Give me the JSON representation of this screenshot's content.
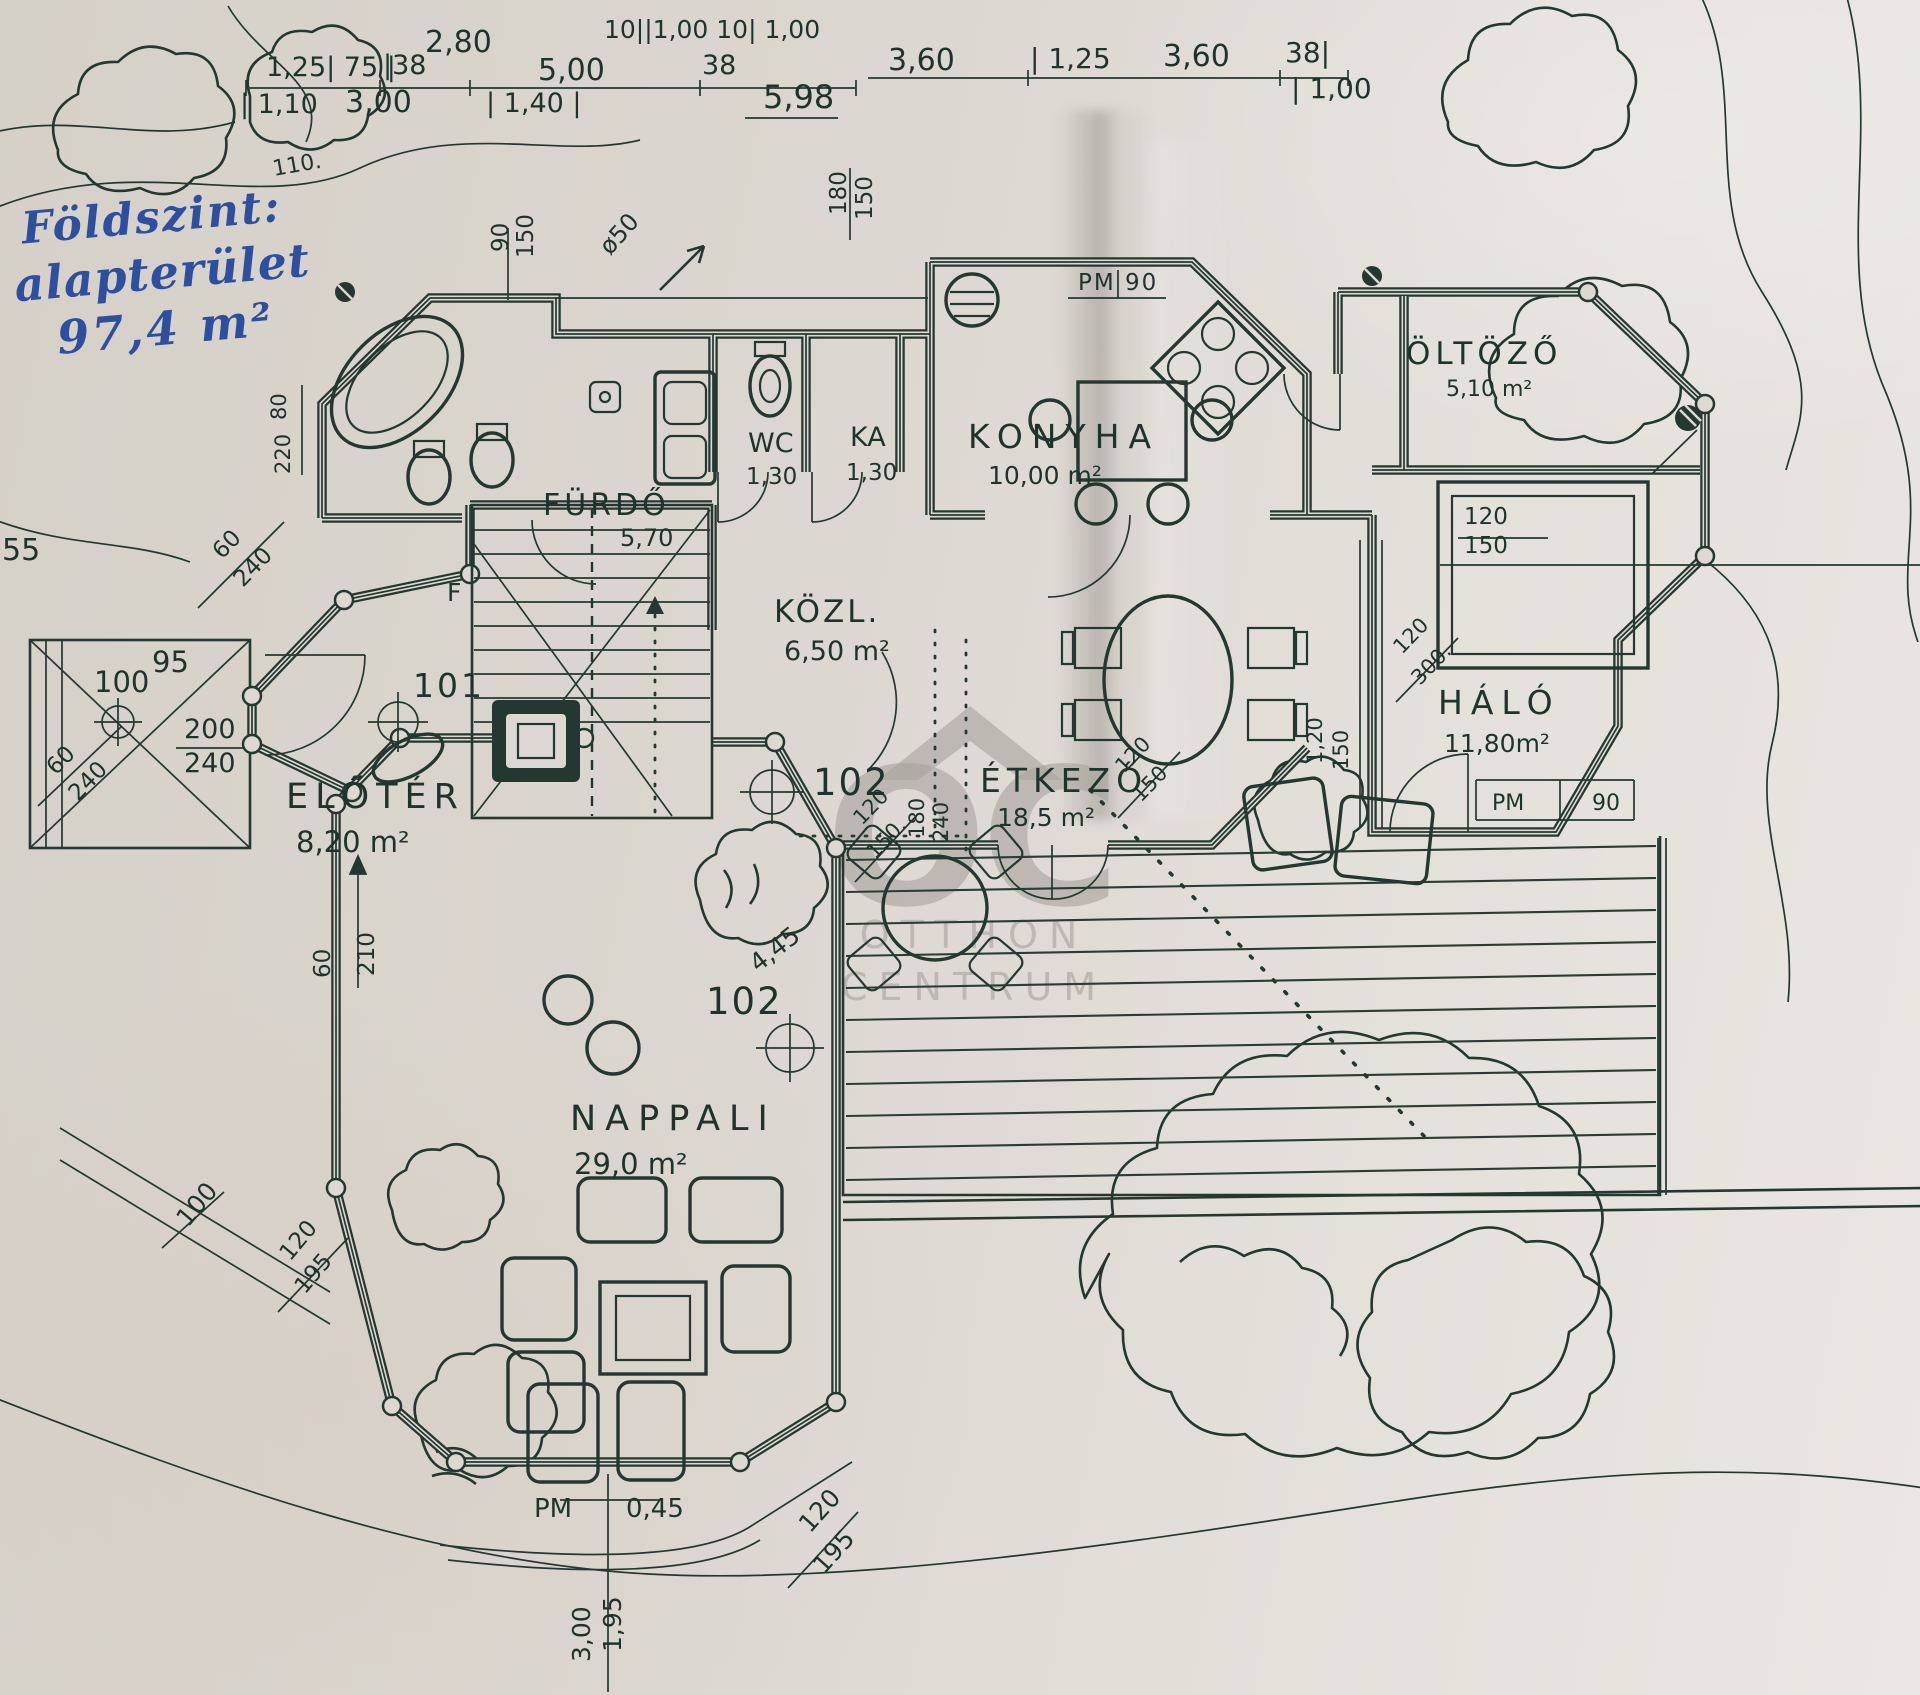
{
  "annotation": {
    "line1": "Földszint:",
    "line2": "alapterület",
    "line3": "97,4 m²",
    "color": "#2d4f9e"
  },
  "watermark": {
    "initials": "OC",
    "line1": "OTTHON",
    "line2": "CENTRUM",
    "color": "#a9a59e"
  },
  "ink_color": "#243831",
  "paper_color": "#ddd8d1",
  "plan_texts": [
    {
      "id": "dim-top-280",
      "t": "2,80",
      "x": 425,
      "y": 52,
      "s": 30
    },
    {
      "id": "dim-top-seq",
      "t": "10||1,00 10| 1,00",
      "x": 604,
      "y": 38,
      "s": 25
    },
    {
      "id": "dim-top-125-75",
      "t": "1,25| 75 |",
      "x": 266,
      "y": 76,
      "s": 27
    },
    {
      "id": "dim-top-38a",
      "t": "|38",
      "x": 383,
      "y": 74,
      "s": 27
    },
    {
      "id": "dim-top-500",
      "t": "5,00",
      "x": 538,
      "y": 80,
      "s": 30
    },
    {
      "id": "dim-top-38b",
      "t": "38",
      "x": 702,
      "y": 74,
      "s": 27
    },
    {
      "id": "dim-top-110",
      "t": "| 1,10",
      "x": 240,
      "y": 113,
      "s": 27
    },
    {
      "id": "dim-top-300",
      "t": "3,00",
      "x": 345,
      "y": 112,
      "s": 30
    },
    {
      "id": "dim-top-140",
      "t": "| 1,40 |",
      "x": 486,
      "y": 112,
      "s": 27
    },
    {
      "id": "dim-top-598",
      "t": "5,98",
      "x": 763,
      "y": 108,
      "s": 32
    },
    {
      "id": "dim-top-360a",
      "t": "3,60",
      "x": 888,
      "y": 70,
      "s": 30
    },
    {
      "id": "dim-top-125b",
      "t": "| 1,25",
      "x": 1030,
      "y": 68,
      "s": 28
    },
    {
      "id": "dim-top-360b",
      "t": "3,60",
      "x": 1163,
      "y": 66,
      "s": 30
    },
    {
      "id": "dim-top-38c",
      "t": "38|",
      "x": 1285,
      "y": 62,
      "s": 28
    },
    {
      "id": "dim-top-100",
      "t": "| 1,00",
      "x": 1291,
      "y": 98,
      "s": 28
    },
    {
      "id": "contour-110",
      "t": "110.",
      "x": 274,
      "y": 176,
      "s": 22,
      "rot": -10
    },
    {
      "id": "dim-v-90",
      "t": "90",
      "x": 508,
      "y": 252,
      "s": 23,
      "rot": -90
    },
    {
      "id": "dim-v-150",
      "t": "150",
      "x": 533,
      "y": 258,
      "s": 23,
      "rot": -90
    },
    {
      "id": "dim-diam-50",
      "t": "ø50",
      "x": 610,
      "y": 256,
      "s": 24,
      "rot": -48
    },
    {
      "id": "dim-v-180",
      "t": "180",
      "x": 846,
      "y": 215,
      "s": 23,
      "rot": -90
    },
    {
      "id": "dim-v-150b",
      "t": "150",
      "x": 872,
      "y": 220,
      "s": 23,
      "rot": -90
    },
    {
      "id": "pm-konyha",
      "t": "PM 90",
      "x": 1078,
      "y": 290,
      "s": 23,
      "ls": 2
    },
    {
      "id": "dim-left-55",
      "t": "55",
      "x": 2,
      "y": 560,
      "s": 30
    },
    {
      "id": "dim-left-80",
      "t": "80",
      "x": 286,
      "y": 420,
      "s": 21,
      "rot": -90
    },
    {
      "id": "dim-left-220",
      "t": "220",
      "x": 290,
      "y": 474,
      "s": 21,
      "rot": -90
    },
    {
      "id": "dim-diag-60a",
      "t": "60",
      "x": 222,
      "y": 560,
      "s": 23,
      "rot": -46
    },
    {
      "id": "dim-diag-240a",
      "t": "240",
      "x": 243,
      "y": 588,
      "s": 23,
      "rot": -46
    },
    {
      "id": "dim-annex-95",
      "t": "95",
      "x": 152,
      "y": 672,
      "s": 29
    },
    {
      "id": "dim-annex-100",
      "t": "100",
      "x": 94,
      "y": 692,
      "s": 29
    },
    {
      "id": "dim-annex-200",
      "t": "200",
      "x": 184,
      "y": 738,
      "s": 27
    },
    {
      "id": "dim-annex-240",
      "t": "240",
      "x": 184,
      "y": 772,
      "s": 27
    },
    {
      "id": "marker-101",
      "t": "101",
      "x": 413,
      "y": 697,
      "s": 33,
      "ls": 3
    },
    {
      "id": "marker-f",
      "t": "F",
      "x": 447,
      "y": 601,
      "s": 25
    },
    {
      "id": "dim-diag-60b",
      "t": "60",
      "x": 56,
      "y": 776,
      "s": 23,
      "rot": -46
    },
    {
      "id": "dim-diag-240b",
      "t": "240",
      "x": 78,
      "y": 802,
      "s": 23,
      "rot": -46
    },
    {
      "id": "dim-v-60",
      "t": "60",
      "x": 330,
      "y": 978,
      "s": 23,
      "rot": -90
    },
    {
      "id": "dim-v-210",
      "t": "210",
      "x": 374,
      "y": 976,
      "s": 23,
      "rot": -90
    },
    {
      "id": "dim-diag-100",
      "t": "100",
      "x": 188,
      "y": 1228,
      "s": 25,
      "rot": -50
    },
    {
      "id": "dim-diag-120a",
      "t": "120",
      "x": 290,
      "y": 1262,
      "s": 23,
      "rot": -50
    },
    {
      "id": "dim-diag-195a",
      "t": "195",
      "x": 305,
      "y": 1295,
      "s": 23,
      "rot": -50
    },
    {
      "id": "room-label-furdo",
      "t": "FÜRDŐ",
      "x": 543,
      "y": 515,
      "s": 30,
      "ls": 4
    },
    {
      "id": "room-area-furdo",
      "t": "5,70",
      "x": 620,
      "y": 546,
      "s": 24
    },
    {
      "id": "room-label-wc",
      "t": "WC",
      "x": 748,
      "y": 452,
      "s": 27
    },
    {
      "id": "room-area-wc",
      "t": "1,30",
      "x": 746,
      "y": 484,
      "s": 23
    },
    {
      "id": "room-label-ka",
      "t": "KA",
      "x": 850,
      "y": 446,
      "s": 27
    },
    {
      "id": "room-area-ka",
      "t": "1,30",
      "x": 846,
      "y": 480,
      "s": 23
    },
    {
      "id": "room-label-konyha",
      "t": "KONYHA",
      "x": 968,
      "y": 448,
      "s": 33,
      "ls": 9
    },
    {
      "id": "room-area-konyha",
      "t": "10,00 m²",
      "x": 988,
      "y": 484,
      "s": 25
    },
    {
      "id": "room-label-oltozo",
      "t": "ÖLTÖZŐ",
      "x": 1406,
      "y": 364,
      "s": 31,
      "ls": 5
    },
    {
      "id": "room-area-oltozo",
      "t": "5,10 m²",
      "x": 1446,
      "y": 396,
      "s": 22
    },
    {
      "id": "room-label-kozl",
      "t": "KÖZL.",
      "x": 774,
      "y": 622,
      "s": 31,
      "ls": 3
    },
    {
      "id": "room-area-kozl",
      "t": "6,50 m²",
      "x": 784,
      "y": 660,
      "s": 27
    },
    {
      "id": "room-label-etkezo",
      "t": "ÉTKEZŐ",
      "x": 980,
      "y": 792,
      "s": 33,
      "ls": 6
    },
    {
      "id": "room-area-etkezo",
      "t": "18,5 m²",
      "x": 997,
      "y": 826,
      "s": 25
    },
    {
      "id": "room-label-halo",
      "t": "HÁLÓ",
      "x": 1438,
      "y": 714,
      "s": 33,
      "ls": 8
    },
    {
      "id": "room-area-halo",
      "t": "11,80m²",
      "x": 1444,
      "y": 752,
      "s": 25
    },
    {
      "id": "room-label-eloter",
      "t": "ELŐTÉR",
      "x": 286,
      "y": 808,
      "s": 35,
      "ls": 7
    },
    {
      "id": "room-area-eloter",
      "t": "8,20 m²",
      "x": 296,
      "y": 852,
      "s": 29
    },
    {
      "id": "room-label-nappali",
      "t": "NAPPALI",
      "x": 570,
      "y": 1130,
      "s": 35,
      "ls": 9
    },
    {
      "id": "room-area-nappali",
      "t": "29,0 m²",
      "x": 574,
      "y": 1174,
      "s": 29
    },
    {
      "id": "marker-102-kozl",
      "t": "102",
      "x": 813,
      "y": 795,
      "s": 37,
      "ls": 2
    },
    {
      "id": "marker-102-nappali",
      "t": "102",
      "x": 706,
      "y": 1014,
      "s": 37,
      "ls": 2
    },
    {
      "id": "dim-445",
      "t": "4,45",
      "x": 758,
      "y": 973,
      "s": 25,
      "rot": -38
    },
    {
      "id": "dim-right-120",
      "t": "120",
      "x": 1464,
      "y": 524,
      "s": 23
    },
    {
      "id": "dim-right-150",
      "t": "150",
      "x": 1464,
      "y": 553,
      "s": 23
    },
    {
      "id": "pm-halo-label",
      "t": "PM",
      "x": 1492,
      "y": 810,
      "s": 22
    },
    {
      "id": "pm-halo-value",
      "t": "90",
      "x": 1592,
      "y": 810,
      "s": 22
    },
    {
      "id": "dim-diag-120b",
      "t": "120",
      "x": 1402,
      "y": 655,
      "s": 21,
      "rot": -46
    },
    {
      "id": "dim-diag-300",
      "t": "300.",
      "x": 1420,
      "y": 686,
      "s": 21,
      "rot": -46
    },
    {
      "id": "dim-v-120",
      "t": "1,20",
      "x": 1322,
      "y": 764,
      "s": 21,
      "rot": -90
    },
    {
      "id": "dim-v-150c",
      "t": "150",
      "x": 1348,
      "y": 770,
      "s": 21,
      "rot": -90
    },
    {
      "id": "dim-diag-120c",
      "t": "120",
      "x": 862,
      "y": 826,
      "s": 21,
      "rot": -46
    },
    {
      "id": "dim-diag-150b",
      "t": "150.",
      "x": 875,
      "y": 860,
      "s": 21,
      "rot": -46
    },
    {
      "id": "dim-v-180b",
      "t": "180",
      "x": 924,
      "y": 838,
      "s": 21,
      "rot": -90
    },
    {
      "id": "dim-v-240b",
      "t": "240",
      "x": 948,
      "y": 842,
      "s": 21,
      "rot": -90
    },
    {
      "id": "dim-diag-120d",
      "t": "120",
      "x": 1124,
      "y": 774,
      "s": 21,
      "rot": -46
    },
    {
      "id": "dim-diag-150c",
      "t": "150",
      "x": 1141,
      "y": 803,
      "s": 21,
      "rot": -46
    },
    {
      "id": "pm-nappali-label",
      "t": "PM",
      "x": 534,
      "y": 1517,
      "s": 26
    },
    {
      "id": "pm-nappali-value",
      "t": "0,45",
      "x": 626,
      "y": 1517,
      "s": 26
    },
    {
      "id": "dim-v-300",
      "t": "3,00",
      "x": 590,
      "y": 1662,
      "s": 25,
      "rot": -90
    },
    {
      "id": "dim-v-195",
      "t": "1,95",
      "x": 621,
      "y": 1652,
      "s": 25,
      "rot": -90
    },
    {
      "id": "dim-diag-120e",
      "t": "120",
      "x": 810,
      "y": 1534,
      "s": 25,
      "rot": -48
    },
    {
      "id": "dim-diag-195b",
      "t": "195",
      "x": 824,
      "y": 1575,
      "s": 25,
      "rot": -48
    }
  ]
}
